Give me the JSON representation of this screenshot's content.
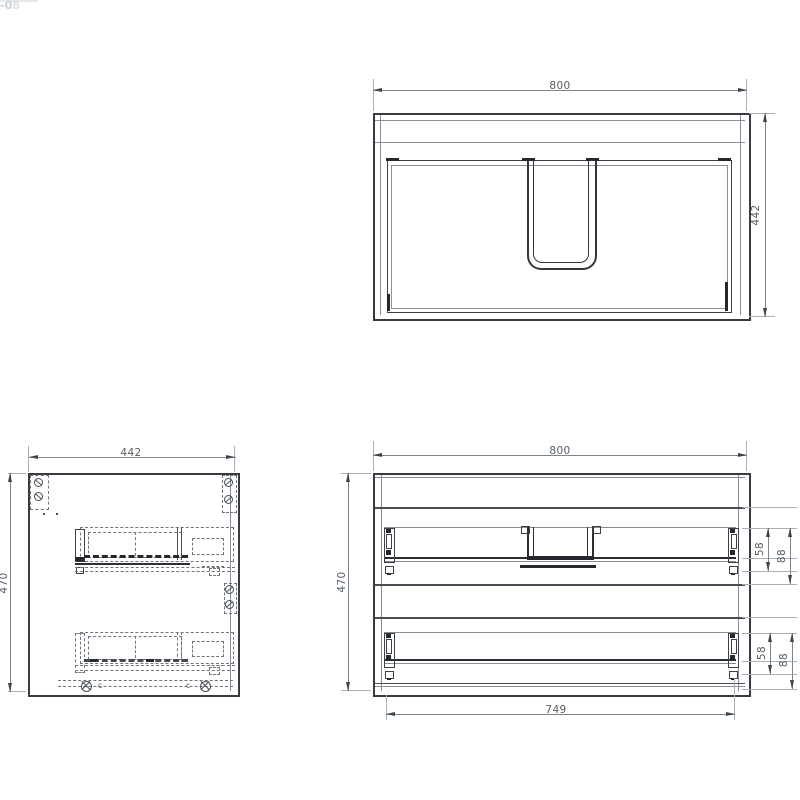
{
  "drawing": {
    "top_view": {
      "width": "800",
      "depth": "442"
    },
    "side_view": {
      "width": "442",
      "height": "470",
      "clip_left": "c",
      "clip_right": "c"
    },
    "front_view": {
      "width": "800",
      "height": "470",
      "inner_width": "749",
      "upper_rail": {
        "rail_height": "58",
        "rail_offset": "88"
      },
      "lower_rail": {
        "rail_height": "58",
        "rail_offset": "88"
      }
    },
    "edge_artifacts": {
      "line1": "-08",
      "line2": "-0"
    }
  },
  "colors": {
    "outline": "#383c42",
    "line": "#4a4e54",
    "hidden_line": "#70757c",
    "dimension": "#7b838b",
    "dim_text": "#565c63",
    "background": "#ffffff"
  }
}
